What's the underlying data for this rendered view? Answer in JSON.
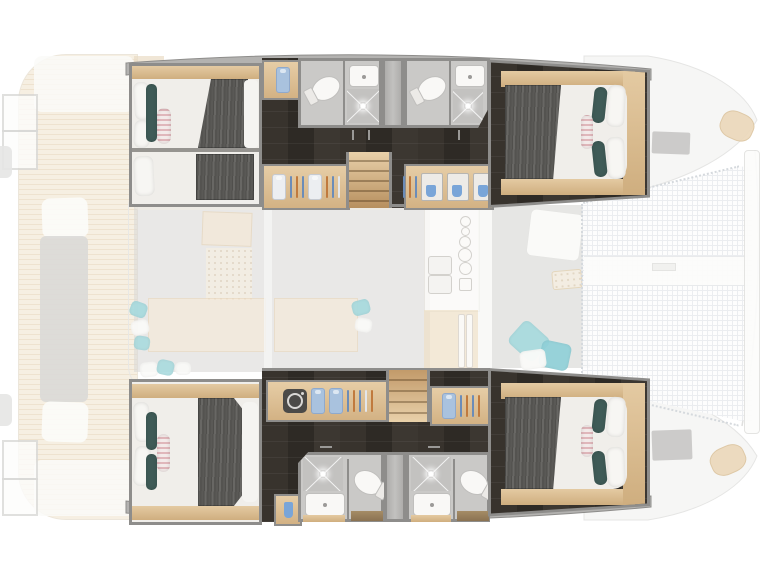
{
  "document": {
    "kind": "yacht-floor-plan",
    "subject": "catamaran-4-cabin-lower-deck-layout",
    "visible_text": []
  },
  "palette": {
    "page_bg": "#ffffff",
    "hull_band": "#b3b2b0",
    "hull_edge": "#8e8d8b",
    "wall": "#8e8d8b",
    "wood_hi": "#e4caa2",
    "wood_lo": "#cfae7f",
    "bath_floor": "#cac9c7",
    "shower_floor": "#c3c2c0",
    "shaft": "#b8b7b5",
    "fixture": "#f9f8f6",
    "fixture_edge": "#c0bfbd",
    "mattress": "#f0eeea",
    "teal_pillow": "#3f5b57",
    "shirt_blue": "#a9c2de",
    "hanger_blue": "#6b8cb8",
    "hanger_orange": "#c07a3e",
    "drawer_blue": "#79a5d8",
    "washer_dark": "#4b4a48",
    "faded_gray": "#dad9d7",
    "faded_beige": "#f4e9d8",
    "faded_teal": "#a6dade",
    "tramp_grid": "#e9ecef",
    "outline_faint": "#e7e7e5"
  },
  "regions": {
    "port_hull": {
      "aft_cabin": {
        "features": [
          "double-bed",
          "pillows",
          "teal-bolster",
          "striped-pillow",
          "gray-blanket",
          "wood-shelf"
        ]
      },
      "corridor": {
        "features": [
          "dark-wood-floor",
          "wardrobe-hangers",
          "staircase",
          "drawer-unit",
          "shirt-closet"
        ]
      },
      "bathrooms": [
        {
          "features": [
            "toilet",
            "sink",
            "shower",
            "sparkle-light"
          ]
        },
        {
          "features": [
            "toilet",
            "sink",
            "shower",
            "sparkle-light"
          ]
        }
      ],
      "forward_cabin": {
        "features": [
          "double-bed",
          "gray-blanket",
          "teal-bolsters",
          "striped-pillow",
          "wood-platform"
        ]
      }
    },
    "starboard_hull": {
      "aft_cabin": {
        "features": [
          "double-bed",
          "pillows",
          "teal-bolsters",
          "striped-pillow",
          "gray-blanket",
          "wood-shelf"
        ]
      },
      "corridor": {
        "features": [
          "dark-wood-floor",
          "washing-machine",
          "shirt-closet",
          "wardrobe-hangers",
          "staircase"
        ]
      },
      "bathrooms": [
        {
          "features": [
            "shower",
            "sink",
            "toilet",
            "sparkle-light"
          ]
        },
        {
          "features": [
            "shower",
            "sink",
            "toilet",
            "sparkle-light"
          ]
        }
      ],
      "forward_cabin": {
        "features": [
          "double-bed",
          "gray-blanket",
          "teal-bolsters",
          "striped-pillow",
          "wood-platform"
        ]
      }
    },
    "main_deck_faded": {
      "aft_cockpit": [
        "teak-deck",
        "bench-seat",
        "swim-ladder-frames",
        "transom-steps"
      ],
      "salon": [
        "nav-station",
        "perforated-mat",
        "sofa-benches",
        "cushions",
        "galley-stove",
        "galley-sink",
        "refrigerator"
      ],
      "forward_cockpit": [
        "lounge-mat",
        "table",
        "tray",
        "teal-cushions"
      ],
      "foredeck": [
        "trampoline-net",
        "lacing-dots",
        "crossbeam-band",
        "bow-beam",
        "deck-hatches",
        "bow-seat-pads"
      ]
    }
  },
  "icons": [
    "washing-machine-icon",
    "hanger-icon",
    "shirt-icon",
    "toilet-icon",
    "sink-icon",
    "shower-x-icon",
    "sparkle-icon",
    "burner-icon",
    "drawer-towel-icon"
  ]
}
